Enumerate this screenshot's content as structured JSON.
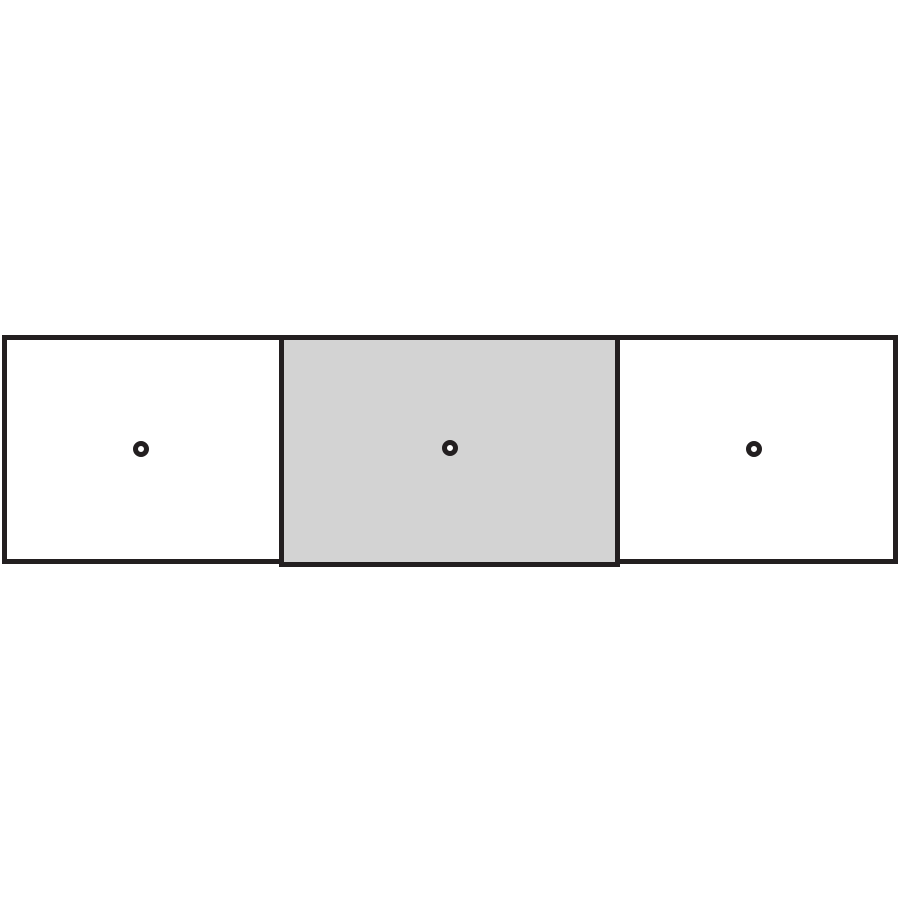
{
  "diagram": {
    "type": "assembly-panel-diagram",
    "background": "#ffffff",
    "outline_color": "#231f20",
    "panels": [
      {
        "id": "left",
        "fill": "#ffffff",
        "hole": {
          "ring_color": "#231f20",
          "center_color": "#ffffff"
        }
      },
      {
        "id": "middle",
        "fill": "#d3d3d3",
        "hole": {
          "ring_color": "#231f20",
          "center_color": "#ffffff"
        }
      },
      {
        "id": "right",
        "fill": "#ffffff",
        "hole": {
          "ring_color": "#231f20",
          "center_color": "#ffffff"
        }
      }
    ]
  }
}
